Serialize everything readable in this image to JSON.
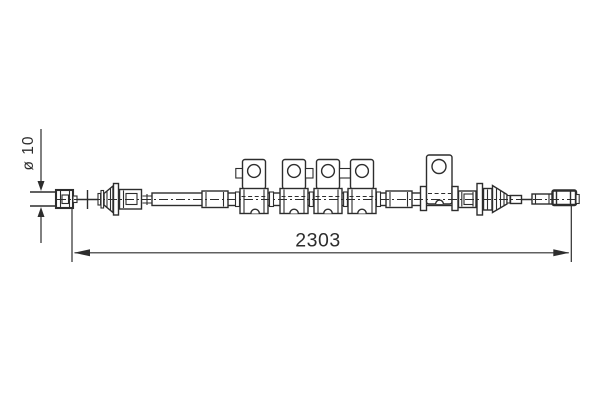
{
  "drawing": {
    "background_color": "#ffffff",
    "line_color": "#2d2d2d",
    "dimensions": {
      "overall_length": {
        "label": "2303"
      },
      "cable_diameter": {
        "label": "ø 10"
      }
    }
  }
}
